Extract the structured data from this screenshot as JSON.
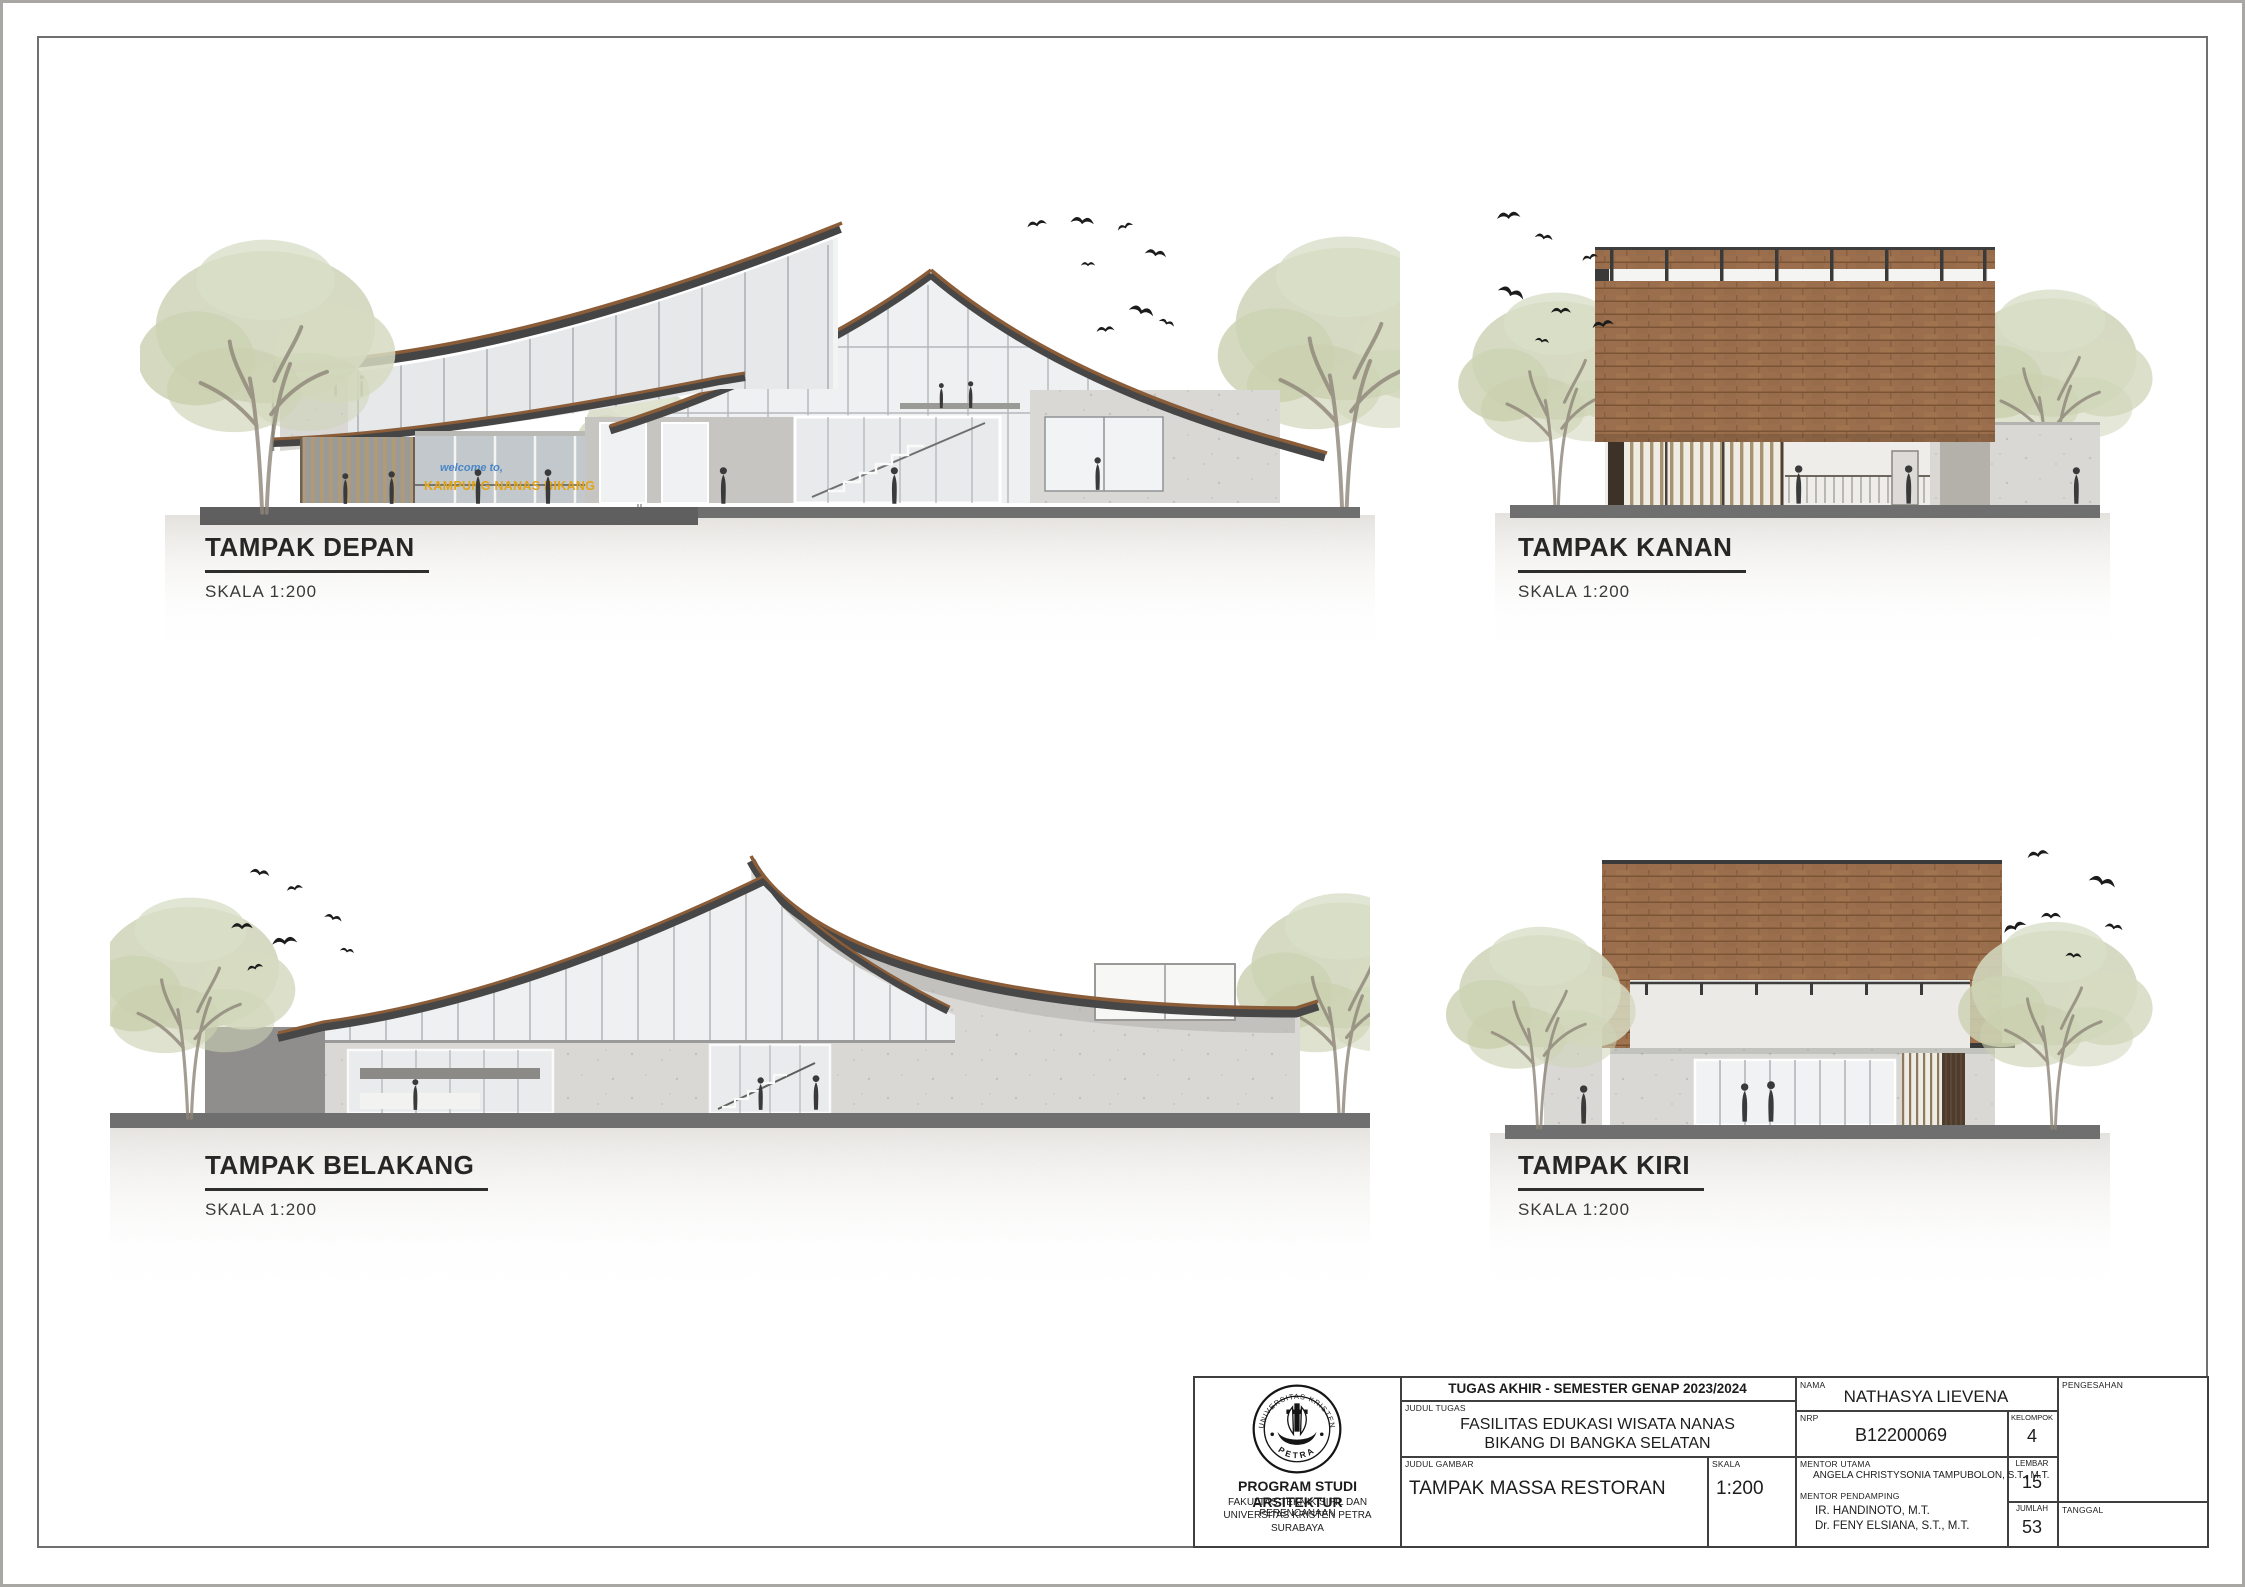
{
  "elevations": {
    "depan": {
      "title": "TAMPAK DEPAN",
      "scale": "SKALA 1:200"
    },
    "kanan": {
      "title": "TAMPAK KANAN",
      "scale": "SKALA 1:200"
    },
    "belakang": {
      "title": "TAMPAK BELAKANG",
      "scale": "SKALA 1:200"
    },
    "kiri": {
      "title": "TAMPAK KIRI",
      "scale": "SKALA 1:200"
    }
  },
  "signage": {
    "line1": "welcome to,",
    "line2": "KAMPUNG NANAS BIKANG",
    "line1_color": "#4a86c8",
    "line2_color": "#e3a417"
  },
  "titleblock": {
    "header": "TUGAS AKHIR - SEMESTER GENAP 2023/2024",
    "judul_tugas_label": "JUDUL TUGAS",
    "judul_tugas_line1": "FASILITAS EDUKASI WISATA NANAS",
    "judul_tugas_line2": "BIKANG DI BANGKA SELATAN",
    "judul_gambar_label": "JUDUL GAMBAR",
    "judul_gambar": "TAMPAK MASSA RESTORAN",
    "skala_label": "SKALA",
    "skala_value": "1:200",
    "nama_label": "NAMA",
    "nama_value": "NATHASYA LIEVENA",
    "nrp_label": "NRP",
    "nrp_value": "B12200069",
    "kelompok_label": "KELOMPOK",
    "kelompok_value": "4",
    "mentor_utama_label": "MENTOR UTAMA",
    "mentor_utama_value": "ANGELA CHRISTYSONIA TAMPUBOLON, S.T., M.T.",
    "mentor_pendamping_label": "MENTOR PENDAMPING",
    "mentor_pendamping_1": "IR. HANDINOTO, M.T.",
    "mentor_pendamping_2": "Dr. FENY ELSIANA, S.T., M.T.",
    "lembar_label": "LEMBAR",
    "lembar_value": "15",
    "jumlah_label": "JUMLAH",
    "jumlah_value": "53",
    "pengesahan_label": "PENGESAHAN",
    "tanggal_label": "TANGGAL",
    "institution": {
      "logo_arc_top": "UNIVERSITAS KRISTEN",
      "logo_arc_bottom": "PETRA",
      "program": "PROGRAM STUDI ARSITEKTUR",
      "faculty": "FAKULTAS TEKNIK SIPIL DAN PERENCANAAN",
      "university": "UNIVERSITAS KRISTEN PETRA",
      "city": "SURABAYA"
    }
  },
  "colors": {
    "brick": "#9b6f4d",
    "brick_joint": "#7b5435",
    "roof_fascia": "#474747",
    "roof_cap": "#8a5c38",
    "concrete": "#d9d8d5",
    "stone_wall": "#c7c5c2",
    "glass": "#eceef0",
    "mullion": "#a7abae",
    "dark_wall": "#8f8e8c",
    "ground_strip": "#6f6f6f",
    "ground_wash": "#dcd9d3",
    "foliage": "#d2d6bc",
    "trunk": "#8d8578",
    "bird": "#1c1c1c",
    "figure": "#3a3a3a"
  }
}
